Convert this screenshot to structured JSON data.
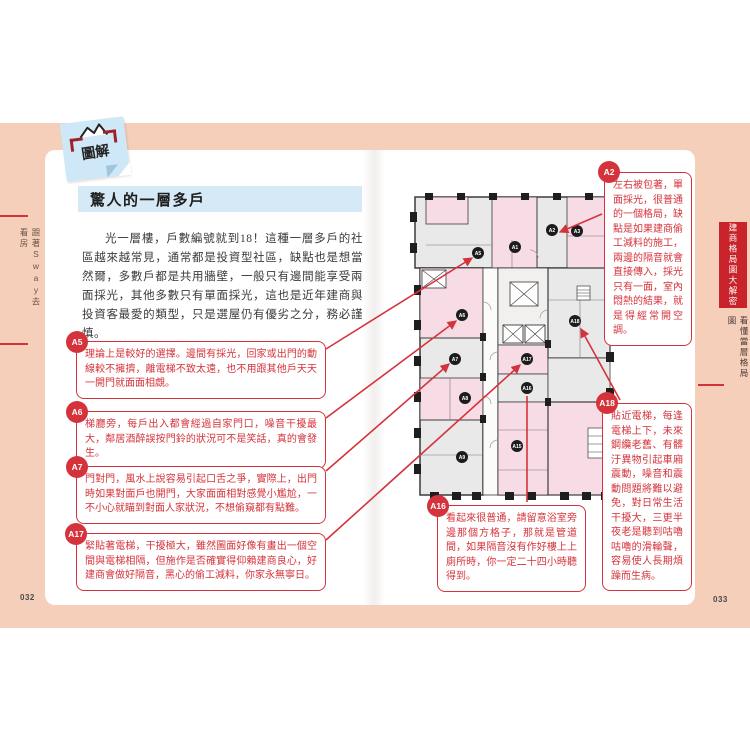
{
  "book": {
    "sticker_label": "圖解",
    "section_title": "驚人的一層多戶",
    "intro": "光一層樓，戶數編號就到18！這種一層多戶的社區越來越常見，通常都是投資型社區，缺點也是想當然爾，多數戶都是共用牆壁，一般只有邊間能享受兩面採光，其他多數只有單面採光，這也是近年建商與投資客最愛的類型，只是選屋仍有優劣之分，務必謹慎。",
    "page_left": "032",
    "page_right": "033",
    "margin_left_label": "跟著Sway去看房",
    "margin_right_tab": "建商格局圖大解密",
    "margin_right_section": "看懂當層格局圖"
  },
  "callouts": {
    "a5": {
      "id": "A5",
      "text": "理論上是較好的選擇。邊間有採光，回家或出門的動線較不擁擠，離電梯不致太遠，也不用跟其他戶天天一開門就面面相覷。"
    },
    "a6": {
      "id": "A6",
      "text": "梯廳旁，每戶出入都會經過自家門口，噪音干擾最大，鄰居酒醉誤按門鈴的狀況可不是笑話，真的會發生。"
    },
    "a7": {
      "id": "A7",
      "text": "門對門，風水上說容易引起口舌之爭，實際上，出門時如果對面戶也開門，大家面面相對感覺小尷尬，一不小心就瞄到對面人家狀況，不想偷窺都有點難。"
    },
    "a17": {
      "id": "A17",
      "text": "緊貼著電梯，干擾極大，雖然圖面好像有畫出一個空間與電梯相隔，但施作是否確實得仰賴建商良心，好建商會做好隔音，黑心的偷工減料，你家永無寧日。"
    },
    "a2": {
      "id": "A2",
      "text": "左右被包著，單面採光，很普通的一個格局，缺點是如果建商偷工減料的施工，兩邊的隔音就會直接傳入，採光只有一面，室內悶熱的結果，就是得經常開空調。"
    },
    "a18": {
      "id": "A18",
      "text": "貼近電梯，每逢電梯上下，未來鋼纜老舊、有髒汙異物引起車廂震動，噪音和震動問題將難以避免，對日常生活干擾大，三更半夜老是聽到咕嚕咕嚕的滑輪聲，容易使人長期煩躁而生病。"
    },
    "a16": {
      "id": "A16",
      "text": "看起來很普通，請留意浴室旁邊那個方格子，那就是管道間，如果隔音沒有作好樓上上廁所時，你一定二十四小時聽得到。"
    }
  },
  "floorplan": {
    "units": {
      "a1": "A1",
      "a2": "A2",
      "a3": "A3",
      "a5": "A5",
      "a6": "A6",
      "a7": "A7",
      "a8": "A8",
      "a9": "A9",
      "a15": "A15",
      "a16": "A16",
      "a17": "A17",
      "a18": "A18"
    }
  },
  "colors": {
    "accent_red": "#d5333b",
    "band_peach": "#f6cfba",
    "note_blue": "#cfe8f7",
    "plan_pink": "#f8dce5",
    "plan_gray": "#e9e9e9",
    "tab_red": "#c9242b",
    "title_blue": "#d5eaf6"
  }
}
